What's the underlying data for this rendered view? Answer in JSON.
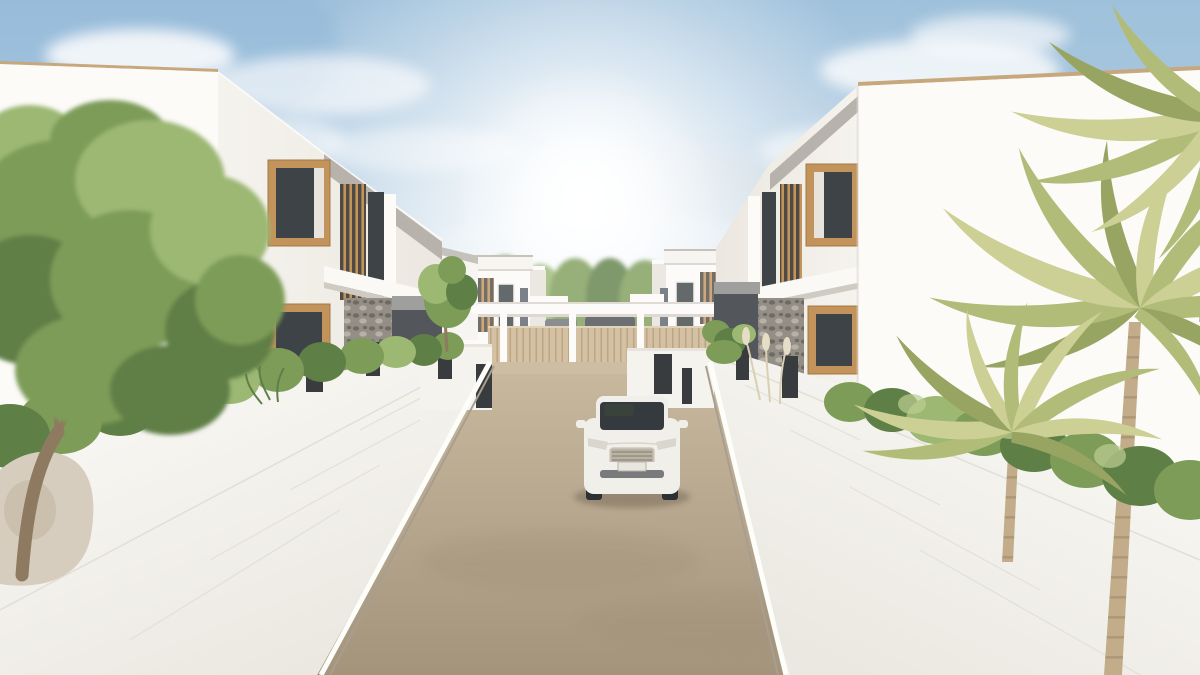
{
  "meta": {
    "title": "Architectural exterior render — modern white villa street",
    "width_px": 1200,
    "height_px": 675
  },
  "palette": {
    "sky-top": "#9fc1dc",
    "sky-mid": "#cfdfec",
    "sky-low": "#f3f0e9",
    "sun": "#ffffff",
    "cloud": "#f8fafc",
    "cloud-shadow": "#c2ccd5",
    "wall-white": "#f5f3ee",
    "wall-bright": "#fcfbf8",
    "wall-shade": "#e6e2da",
    "wall-dark": "#d5d0c7",
    "roof-trim": "#c8a77c",
    "fascia": "#b7b3ac",
    "soffit": "#9fa09d",
    "wood": "#c2935a",
    "glass-dark": "#3d4347",
    "glass-mid": "#59626a",
    "slat-bg": "#4f4a43",
    "stone": "#938e86",
    "stone-dark": "#6f6b64",
    "stone-light": "#b6b0a7",
    "garage": "#53565a",
    "pillar": "#393c3e",
    "fence": "#cab28c",
    "fence-line": "#a98f66",
    "fence-rail": "#d9c8a4",
    "road-far": "#c9b99f",
    "road-near": "#a4947c",
    "curb": "#a0968a",
    "green-deep": "#5e7f46",
    "green-mid": "#7d9c58",
    "green-light": "#9cb873",
    "green-pale": "#bccd92",
    "palm-light": "#ccd094",
    "palm-mid": "#b2bc79",
    "palm-dark": "#98a562",
    "palm-trunk": "#c2ac8a",
    "palm-trunk-dark": "#a28b6a",
    "tree-trunk": "#8e7a60",
    "rock": "#d7cdbf",
    "car-body": "#f1efe9",
    "car-glass": "#343a3d",
    "car-dark": "#55585a",
    "grass": "#a3b577"
  },
  "scene": {
    "sky": {
      "label": "Bright hazy blue sky with scattered clouds"
    },
    "sun": {
      "label": "Sun glow above the street center"
    },
    "backdrop_trees": {
      "label": "Green trees behind the entrance fence"
    },
    "far_house_left": {
      "label": "White villa with timber slat screen, left of street entrance"
    },
    "far_house_right": {
      "label": "White villa with timber slat screen, right of street entrance"
    },
    "gate": {
      "label": "Timber slat entrance fence with white pergola beam and posts"
    },
    "middle_house_left": {
      "label": "Second white villa on the left"
    },
    "middle_house_right": {
      "label": "Second white villa on the right"
    },
    "house_left": {
      "label": "Foreground two-storey white villa, timber-framed windows, stone pier, garage"
    },
    "house_right": {
      "label": "Foreground two-storey white villa with large blank facade"
    },
    "wall_left": {
      "label": "White boundary wall with dark piers, left side"
    },
    "wall_right": {
      "label": "White boundary wall with dark piers, right side"
    },
    "road": {
      "label": "Beige street receding toward the entrance gate"
    },
    "car": {
      "label": "White hatchback driving up the middle of the street"
    },
    "tree": {
      "label": "Leafy green tree at far left"
    },
    "palms": {
      "label": "Areca palm trees on the right"
    },
    "hedges": {
      "label": "Green hedges along both boundary walls"
    }
  }
}
